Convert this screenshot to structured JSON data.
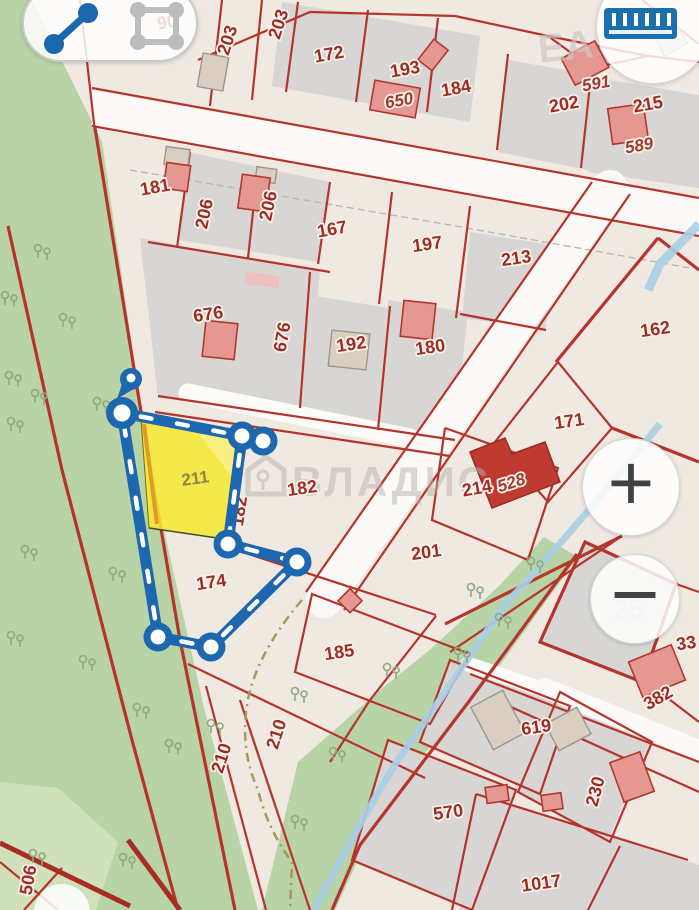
{
  "app": {
    "type": "cadastral-map-measure-view"
  },
  "controls": {
    "measure_distance_tool": {
      "icon": "polyline-measure-icon",
      "active": true
    },
    "measure_area_tool": {
      "icon": "polygon-measure-icon",
      "active": false
    },
    "ruler_tool": {
      "icon": "ruler-icon"
    },
    "zoom_in_label": "+",
    "zoom_out_label": "−"
  },
  "watermark": {
    "text": "ВЛАДИС",
    "icon": "house-key-icon"
  },
  "map": {
    "highlighted_parcel": {
      "number": "211",
      "fill": "#f6e834"
    },
    "parcel_labels": [
      {
        "t": "90",
        "x": 168,
        "y": 28,
        "r": -10
      },
      {
        "t": "203",
        "x": 233,
        "y": 42,
        "r": -72
      },
      {
        "t": "203",
        "x": 284,
        "y": 26,
        "r": -72
      },
      {
        "t": "172",
        "x": 330,
        "y": 60,
        "r": -10
      },
      {
        "t": "193",
        "x": 406,
        "y": 75,
        "r": -10
      },
      {
        "t": "650",
        "x": 400,
        "y": 106,
        "r": -10,
        "s": "italic"
      },
      {
        "t": "184",
        "x": 457,
        "y": 94,
        "r": -10
      },
      {
        "t": "202",
        "x": 565,
        "y": 110,
        "r": -10
      },
      {
        "t": "591",
        "x": 597,
        "y": 89,
        "r": -10,
        "s": "italic"
      },
      {
        "t": "215",
        "x": 649,
        "y": 110,
        "r": -10
      },
      {
        "t": "589",
        "x": 640,
        "y": 151,
        "r": -10,
        "s": "italic"
      },
      {
        "t": "181",
        "x": 156,
        "y": 193,
        "r": -10
      },
      {
        "t": "206",
        "x": 210,
        "y": 215,
        "r": -78
      },
      {
        "t": "206",
        "x": 274,
        "y": 207,
        "r": -78
      },
      {
        "t": "167",
        "x": 333,
        "y": 235,
        "r": -10
      },
      {
        "t": "197",
        "x": 428,
        "y": 250,
        "r": -8
      },
      {
        "t": "213",
        "x": 517,
        "y": 264,
        "r": -8
      },
      {
        "t": "162",
        "x": 656,
        "y": 335,
        "r": -8
      },
      {
        "t": "676",
        "x": 209,
        "y": 320,
        "r": -8
      },
      {
        "t": "676",
        "x": 288,
        "y": 338,
        "r": -80
      },
      {
        "t": "192",
        "x": 352,
        "y": 350,
        "r": -8
      },
      {
        "t": "180",
        "x": 431,
        "y": 353,
        "r": -8
      },
      {
        "t": "171",
        "x": 570,
        "y": 427,
        "r": -8
      },
      {
        "t": "211",
        "x": 196,
        "y": 484,
        "r": -8,
        "s": "olive"
      },
      {
        "t": "182",
        "x": 303,
        "y": 494,
        "r": -8
      },
      {
        "t": "182",
        "x": 245,
        "y": 512,
        "r": -82
      },
      {
        "t": "214",
        "x": 478,
        "y": 494,
        "r": -10
      },
      {
        "t": "528",
        "x": 513,
        "y": 488,
        "r": -18,
        "s": "italic"
      },
      {
        "t": "201",
        "x": 427,
        "y": 558,
        "r": -8
      },
      {
        "t": "174",
        "x": 212,
        "y": 588,
        "r": -8
      },
      {
        "t": "185",
        "x": 340,
        "y": 658,
        "r": -8
      },
      {
        "t": "25",
        "x": 629,
        "y": 618,
        "r": 0,
        "s": "ghost"
      },
      {
        "t": "33",
        "x": 687,
        "y": 649,
        "r": -8
      },
      {
        "t": "382",
        "x": 661,
        "y": 703,
        "r": -30
      },
      {
        "t": "619",
        "x": 537,
        "y": 733,
        "r": -8
      },
      {
        "t": "230",
        "x": 601,
        "y": 793,
        "r": -75
      },
      {
        "t": "570",
        "x": 449,
        "y": 818,
        "r": -8
      },
      {
        "t": "1017",
        "x": 542,
        "y": 889,
        "r": -8
      },
      {
        "t": "210",
        "x": 227,
        "y": 760,
        "r": -72
      },
      {
        "t": "210",
        "x": 282,
        "y": 736,
        "r": -72
      },
      {
        "t": "506",
        "x": 34,
        "y": 881,
        "r": -80
      },
      {
        "t": "ЕА",
        "x": 567,
        "y": 60,
        "r": -6,
        "s": "ghostbig"
      }
    ]
  },
  "measurement": {
    "color": "#1c67ad",
    "vertices": [
      {
        "x": 131,
        "y": 379,
        "type": "pin"
      },
      {
        "x": 122,
        "y": 413,
        "type": "large"
      },
      {
        "x": 263,
        "y": 441,
        "type": "vertex"
      },
      {
        "x": 242,
        "y": 436,
        "type": "vertex"
      },
      {
        "x": 228,
        "y": 544,
        "type": "vertex"
      },
      {
        "x": 297,
        "y": 562,
        "type": "vertex"
      },
      {
        "x": 211,
        "y": 647,
        "type": "vertex"
      },
      {
        "x": 158,
        "y": 637,
        "type": "vertex"
      }
    ],
    "edges": [
      [
        1,
        3
      ],
      [
        3,
        4
      ],
      [
        4,
        5
      ],
      [
        5,
        6
      ],
      [
        6,
        7
      ],
      [
        7,
        1
      ]
    ]
  },
  "colors": {
    "background": "#efe9e1",
    "parcel_gray": "#d7d6d4",
    "boundary_red": "#b5342b",
    "label_red": "#9c2d25",
    "green_area": "#b8d3a6",
    "green_light": "#cfe0ba",
    "road_white": "#fbfaf8",
    "stream_blue": "#a9cfe5",
    "path_dash": "#a69a58",
    "highlight_yellow": "#f6e834",
    "highlight_orange_edge": "#e39b26",
    "measure_blue": "#1c67ad",
    "watermark_gray": "#b7b4ae"
  }
}
